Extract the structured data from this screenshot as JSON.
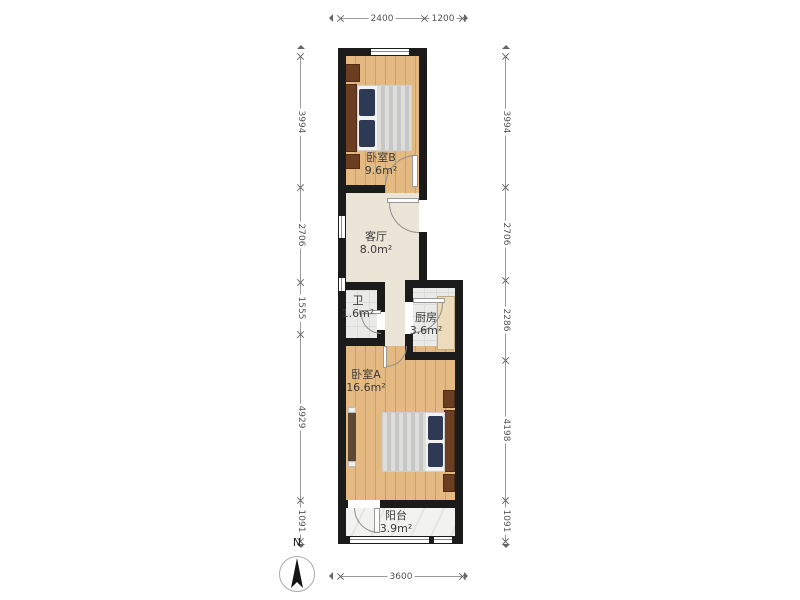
{
  "plan": {
    "rooms": [
      {
        "name": "卧室B",
        "area": "9.6m²"
      },
      {
        "name": "客厅",
        "area": "8.0m²"
      },
      {
        "name": "卫",
        "area": "1.6m²"
      },
      {
        "name": "厨房",
        "area": "3.6m²"
      },
      {
        "name": "卧室A",
        "area": "16.6m²"
      },
      {
        "name": "阳台",
        "area": "3.9m²"
      }
    ],
    "dimensions_mm": {
      "top": [
        "2400",
        "1200"
      ],
      "left": [
        "3994",
        "2706",
        "1555",
        "4929",
        "1091"
      ],
      "right": [
        "3994",
        "2706",
        "2286",
        "4198",
        "1091"
      ],
      "bottom": [
        "3600"
      ]
    },
    "compass": {
      "label": "N"
    },
    "colors": {
      "wall": "#1b1b1b",
      "wood_floor": "#e4ba82",
      "living_floor": "#ebe5d7",
      "tile_floor": "#eaeae8",
      "balcony_floor": "#f2f2f0",
      "pillow": "#2e3a55",
      "dark_wood": "#6b3e22"
    }
  }
}
